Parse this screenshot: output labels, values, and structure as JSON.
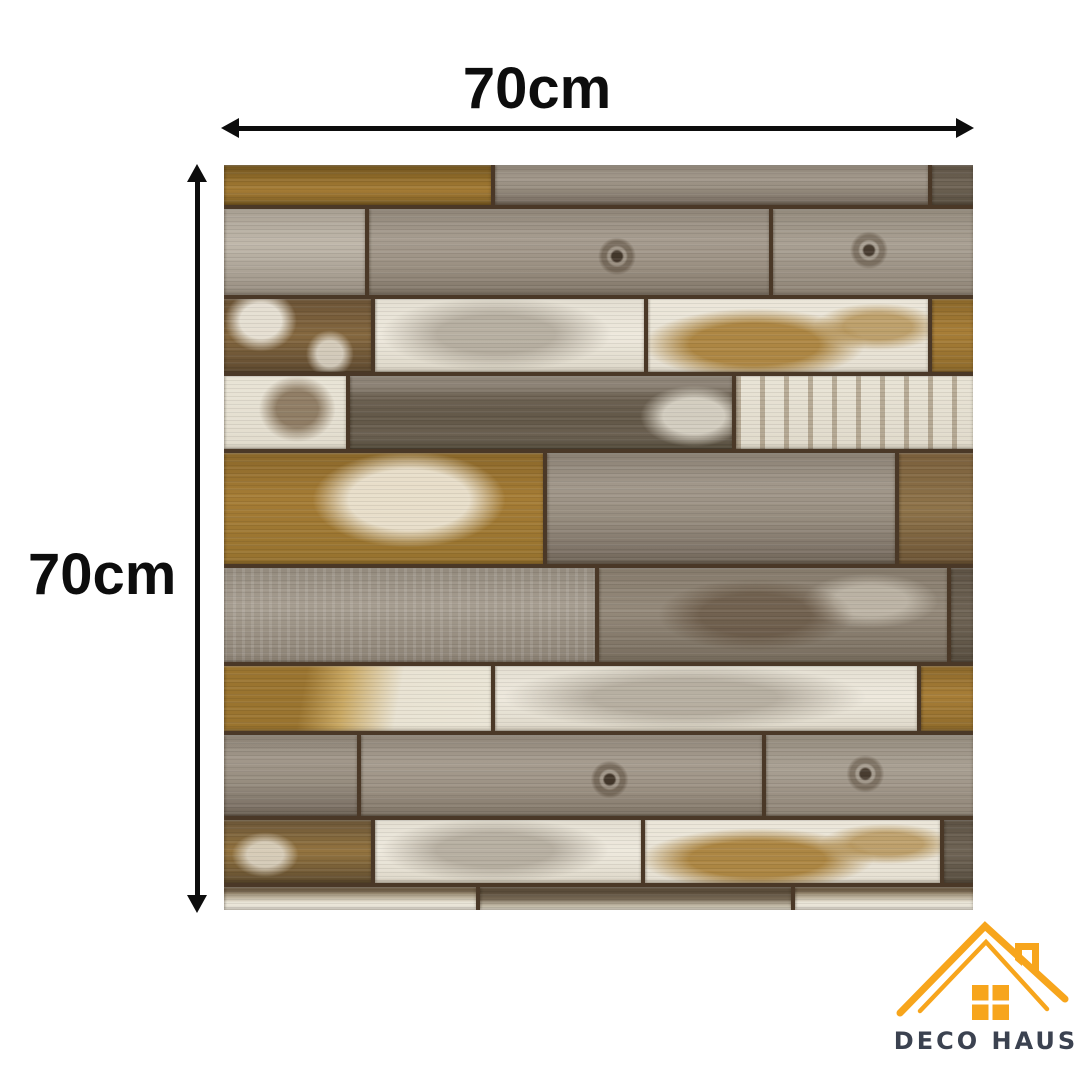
{
  "dimensions": {
    "width_label": "70cm",
    "height_label": "70cm",
    "arrow_color": "#0d0d0d"
  },
  "brand": {
    "name": "DECO HAUS",
    "roof_color": "#F7A51C",
    "text_color": "#3B4250"
  },
  "panel": {
    "description_colors": {
      "seam_dark_brown": "#4a3827",
      "gold_wood": "#A47B34",
      "gray_wood": "#978D80",
      "light_gray_wood": "#B9B0A3",
      "white_paint": "#EBE6DA",
      "dark_gray_brown": "#6F655C"
    },
    "rows": [
      {
        "h": 40,
        "planks": [
          {
            "w": 36,
            "t": "goldDark"
          },
          {
            "w": 58.5,
            "t": "gray"
          },
          {
            "w": 5.5,
            "t": "grayDark"
          }
        ]
      },
      {
        "h": 86,
        "planks": [
          {
            "w": 19,
            "t": "grayLight"
          },
          {
            "w": 54,
            "t": "grayKnot"
          },
          {
            "w": 27,
            "t": "grayKnot2"
          }
        ]
      },
      {
        "h": 73,
        "planks": [
          {
            "w": 20,
            "t": "brownWhite"
          },
          {
            "w": 36.5,
            "t": "whiteGray"
          },
          {
            "w": 38,
            "t": "whiteGold"
          },
          {
            "w": 5.5,
            "t": "gold"
          }
        ]
      },
      {
        "h": 73,
        "planks": [
          {
            "w": 16.5,
            "t": "whiteBrown"
          },
          {
            "w": 51.5,
            "t": "grayDarkPaint"
          },
          {
            "w": 32,
            "t": "whiteStreak"
          }
        ]
      },
      {
        "h": 111,
        "planks": [
          {
            "w": 43,
            "t": "goldWhite"
          },
          {
            "w": 47,
            "t": "gray"
          },
          {
            "w": 10,
            "t": "brown"
          }
        ]
      },
      {
        "h": 94,
        "planks": [
          {
            "w": 50,
            "t": "grayBig"
          },
          {
            "w": 47,
            "t": "grayBrown"
          },
          {
            "w": 3,
            "t": "grayDark"
          }
        ]
      },
      {
        "h": 65,
        "planks": [
          {
            "w": 36,
            "t": "goldWhite2"
          },
          {
            "w": 57,
            "t": "whiteGray"
          },
          {
            "w": 7,
            "t": "gold"
          }
        ]
      },
      {
        "h": 81,
        "planks": [
          {
            "w": 18,
            "t": "gray"
          },
          {
            "w": 54,
            "t": "grayKnot"
          },
          {
            "w": 28,
            "t": "grayKnot2"
          }
        ]
      },
      {
        "h": 63,
        "planks": [
          {
            "w": 20,
            "t": "brownGold"
          },
          {
            "w": 36,
            "t": "whiteGray"
          },
          {
            "w": 40,
            "t": "whiteGold"
          },
          {
            "w": 4,
            "t": "grayDark"
          }
        ]
      },
      {
        "h": 23,
        "planks": [
          {
            "w": 34,
            "t": "fadeWhite"
          },
          {
            "w": 42,
            "t": "fadeDark"
          },
          {
            "w": 24,
            "t": "fadeWhite"
          }
        ]
      }
    ]
  }
}
